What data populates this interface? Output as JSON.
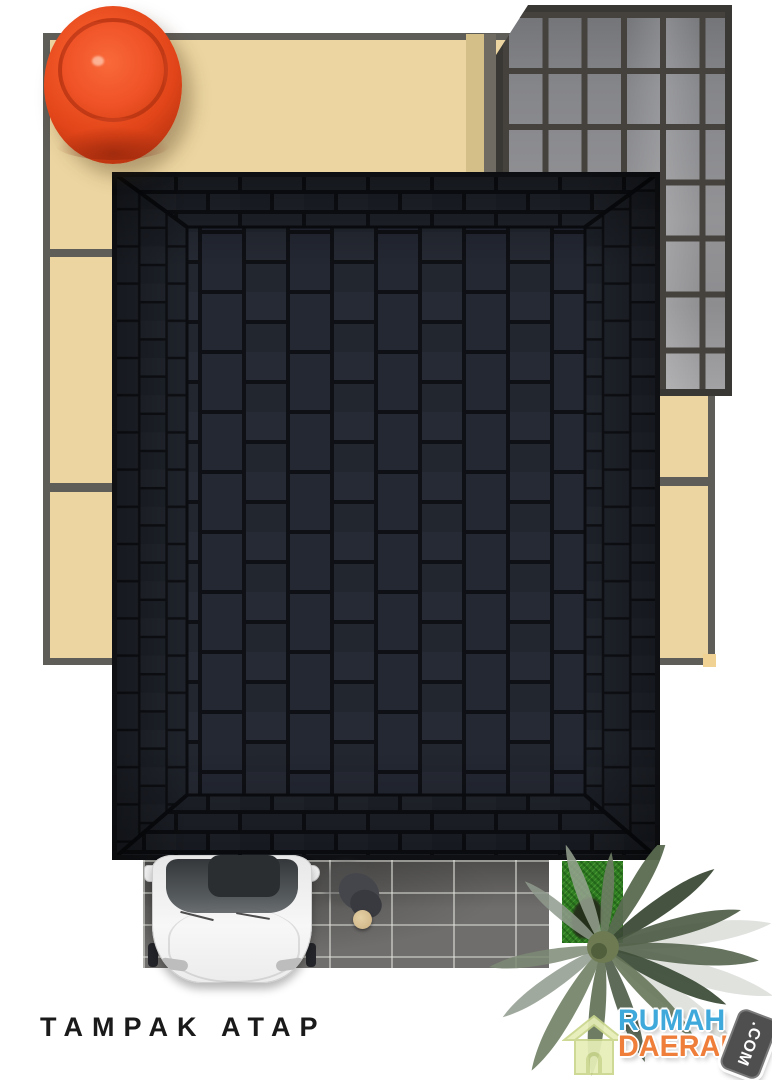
{
  "title": {
    "label": "TAMPAK ATAP"
  },
  "watermark": {
    "word1": "RUMAH",
    "word2": "DAERAH",
    "badge": ".COM",
    "word1_color": "#3fa9dc",
    "word2_color": "#ef7e3a",
    "badge_bg": "#4f4f4f",
    "house_icon_color": "#e7eeb8"
  },
  "scene": {
    "description": "Top-down 3D architectural rendering of a house roof plan",
    "base_slab": {
      "fill": "#ecd5a0",
      "border_color": "#5f5d58"
    },
    "water_tank": {
      "color": "#e8481d",
      "position": "top-left"
    },
    "glass_canopy": {
      "glass_color": "#909094",
      "frame_color": "#3a3834",
      "columns": 6,
      "rows": 7,
      "position": "top-right"
    },
    "shingle_roof": {
      "shingle_color": "#242833",
      "joint_color": "#0e1015",
      "type": "hip roof, dark asphalt shingles"
    },
    "carport_tiles": {
      "tile_color": "#6f6e6c",
      "grout_color": "#c9c9c4"
    },
    "car": {
      "body_color": "#f0f0f0",
      "glass_color": "#46494c",
      "view": "top, parked in carport"
    },
    "person": {
      "shirt_color": "#45464b",
      "hair_color": "#d7c092"
    },
    "grass": {
      "color": "#2f7d22"
    },
    "palm_tree": {
      "foliage_colors": [
        "#3f4f3a",
        "#6f7f63",
        "#97a291"
      ],
      "position": "bottom-right"
    }
  }
}
